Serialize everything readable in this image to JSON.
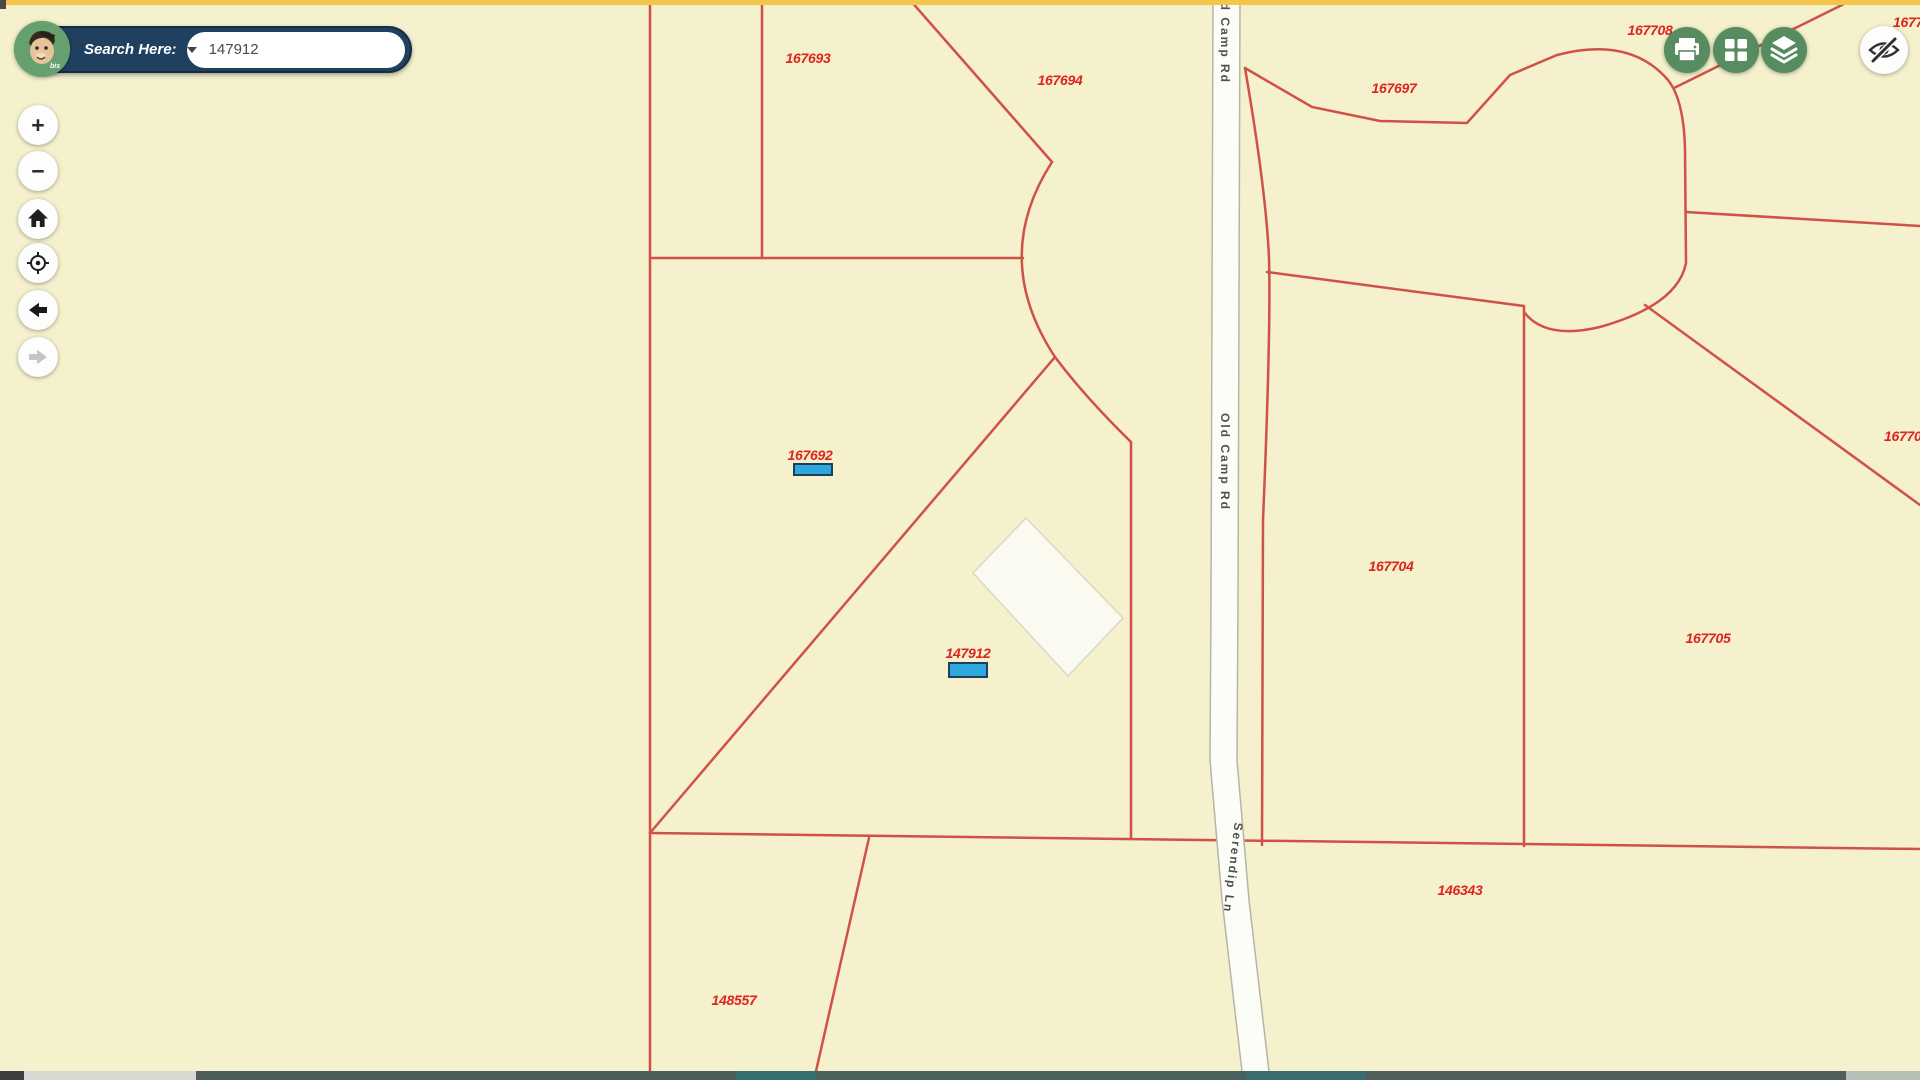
{
  "search_bar": {
    "label": "Search Here:",
    "input_value": "147912",
    "logo_text": "bis"
  },
  "controls": {
    "zoom_in": "+",
    "zoom_out": "−"
  },
  "map": {
    "colors": {
      "background": "#f4f1cc",
      "top_strip": "#f3c64a",
      "parcel_line": "#cf5147",
      "parcel_label": "#de2420",
      "highlight_fill": "#2da7dc",
      "highlight_border": "#1c3f5e",
      "road_fill": "#fdfdf8",
      "road_border": "#b5b5ab",
      "road_label": "#4f4f4f",
      "building_fill": "#fafaf0",
      "building_border": "#d8d8c8"
    },
    "parcel_labels": [
      {
        "text": "167693",
        "x": 808,
        "y": 58
      },
      {
        "text": "167694",
        "x": 1060,
        "y": 80
      },
      {
        "text": "167697",
        "x": 1394,
        "y": 88
      },
      {
        "text": "167708",
        "x": 1650,
        "y": 30
      },
      {
        "text": "1677",
        "x": 1893,
        "y": 22,
        "edge": true
      },
      {
        "text": "167692",
        "x": 810,
        "y": 455
      },
      {
        "text": "147912",
        "x": 968,
        "y": 653
      },
      {
        "text": "167704",
        "x": 1391,
        "y": 566
      },
      {
        "text": "167705",
        "x": 1708,
        "y": 638
      },
      {
        "text": "16770",
        "x": 1884,
        "y": 436,
        "edge": true
      },
      {
        "text": "146343",
        "x": 1460,
        "y": 890
      },
      {
        "text": "148557",
        "x": 734,
        "y": 1000
      }
    ],
    "highlights": [
      {
        "parcel": "167692",
        "x": 793,
        "y": 463,
        "w": 40,
        "h": 13
      },
      {
        "parcel": "147912",
        "x": 948,
        "y": 662,
        "w": 40,
        "h": 16
      }
    ],
    "road_labels": [
      {
        "text": "Old Camp Rd",
        "x": 1225,
        "y": 35,
        "angle": 90
      },
      {
        "text": "Old Camp Rd",
        "x": 1225,
        "y": 462,
        "angle": 90
      },
      {
        "text": "Serendip Ln",
        "x": 1233,
        "y": 868,
        "angle": 97
      }
    ]
  },
  "bottom_bar": {
    "segments": [
      {
        "x": 0,
        "w": 24,
        "color": "#3e3e3e"
      },
      {
        "x": 24,
        "w": 172,
        "color": "#d9d9d1"
      },
      {
        "x": 196,
        "w": 540,
        "color": "#4d5d5a"
      },
      {
        "x": 736,
        "w": 80,
        "color": "#34706e"
      },
      {
        "x": 816,
        "w": 430,
        "color": "#4a625e"
      },
      {
        "x": 1246,
        "w": 120,
        "color": "#3a6e6e"
      },
      {
        "x": 1366,
        "w": 480,
        "color": "#505f5b"
      },
      {
        "x": 1846,
        "w": 74,
        "color": "#b7bfb7"
      }
    ]
  }
}
